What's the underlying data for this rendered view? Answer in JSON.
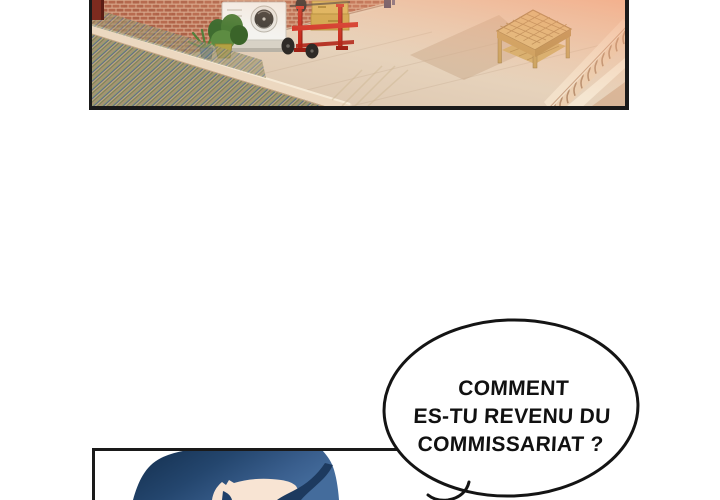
{
  "page": {
    "type": "webtoon-comic-page",
    "background": "#ffffff",
    "panel_border": "#1a1a1a"
  },
  "rooftop_panel": {
    "objects": [
      "brick-wall",
      "red-pillar",
      "mesh-fence",
      "parapet-cap",
      "potted-plants",
      "ac-unit",
      "weight-rack",
      "yellow-crates",
      "weight-plates",
      "wooden-table",
      "roof-railing",
      "floor"
    ],
    "colors": {
      "brick": "#b4674c",
      "mortar": "#d9aa8d",
      "floor": "#e2cdb5",
      "sunset_glow": "#f5a67a",
      "parapet": "#ecd8c0",
      "rack_red": "#c7291c",
      "crate_yellow": "#d9b554",
      "table_wood": "#ddb976",
      "plate_black": "#2c2926",
      "railing": "#ecd0b2"
    }
  },
  "character_panel": {
    "objects": [
      "hair",
      "forehead"
    ],
    "colors": {
      "hair_dark": "#132e4d",
      "hair_light": "#446c9c",
      "hair_fringe": "#1d3a5f",
      "skin": "#f8e4d3"
    }
  },
  "speech_bubble": {
    "line1": "COMMENT",
    "line2": "ES-TU REVENU DU",
    "line3": "COMMISSARIAT ?",
    "fill": "#ffffff",
    "stroke": "#141414"
  }
}
